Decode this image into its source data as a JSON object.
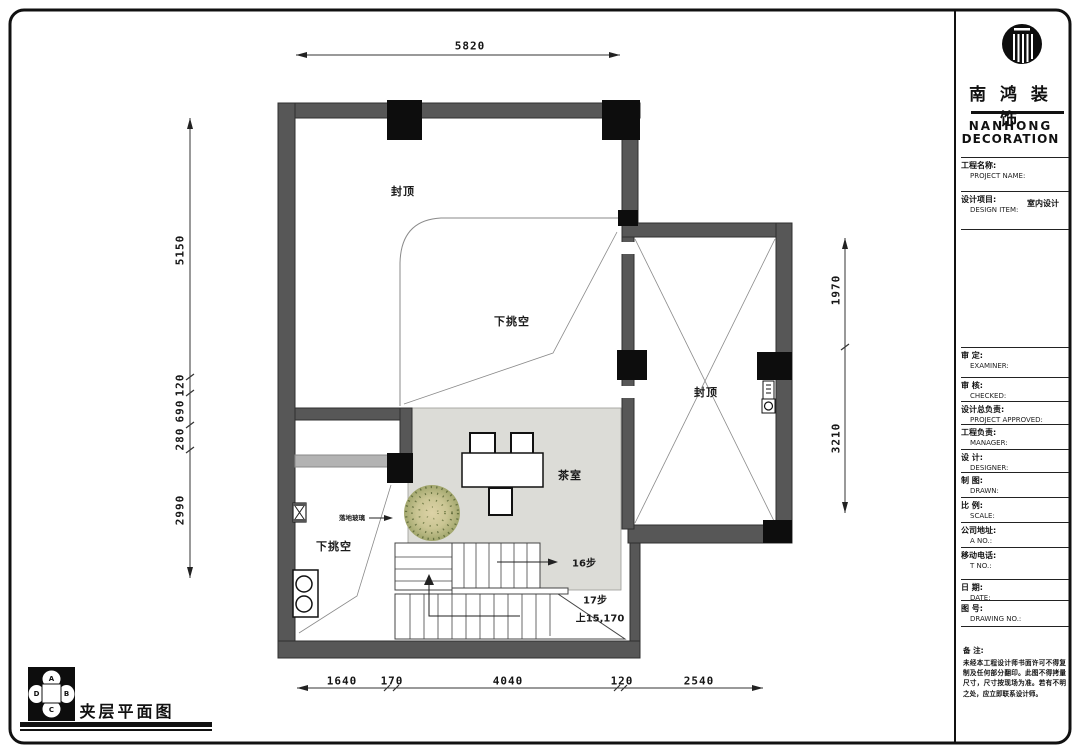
{
  "plan": {
    "rooms": {
      "capped_top": "封顶",
      "void_main": "下挑空",
      "tea_room": "茶室",
      "capped_right": "封顶",
      "void_lower": "下挑空"
    },
    "annotations": {
      "floor_glass": "落地玻璃",
      "steps_upper": "16步",
      "steps_lower": "17步",
      "up_elevation": "上15,170"
    },
    "dimensions": {
      "top": "5820",
      "left_1": "5150",
      "left_2": "120",
      "left_3": "690",
      "left_4": "280",
      "left_5": "2990",
      "right_1": "1970",
      "right_2": "3210",
      "bottom_1": "1640",
      "bottom_2": "170",
      "bottom_3": "4040",
      "bottom_4": "120",
      "bottom_5": "2540"
    }
  },
  "footer": {
    "drawing_title": "夹层平面图",
    "compass": {
      "top": "A",
      "right": "B",
      "bottom": "C",
      "left": "D"
    }
  },
  "titleblock": {
    "brand_cn": "南 鸿 装 饰",
    "brand_en_line1": "NANHONG",
    "brand_en_line2": "DECORATION",
    "fields": [
      {
        "cn": "工程名称:",
        "en": "PROJECT NAME:",
        "value": ""
      },
      {
        "cn": "设计项目:",
        "en": "DESIGN ITEM:",
        "value": "室内设计"
      },
      {
        "cn": "审  定:",
        "en": "EXAMINER:",
        "value": ""
      },
      {
        "cn": "审  核:",
        "en": "CHECKED:",
        "value": ""
      },
      {
        "cn": "设计总负责:",
        "en": "PROJECT APPROVED:",
        "value": ""
      },
      {
        "cn": "工程负责:",
        "en": "MANAGER:",
        "value": ""
      },
      {
        "cn": "设  计:",
        "en": "DESIGNER:",
        "value": ""
      },
      {
        "cn": "制  图:",
        "en": "DRAWN:",
        "value": ""
      },
      {
        "cn": "比  例:",
        "en": "SCALE:",
        "value": ""
      },
      {
        "cn": "公司地址:",
        "en": "A  NO.:",
        "value": ""
      },
      {
        "cn": "移动电话:",
        "en": "T  NO.:",
        "value": ""
      },
      {
        "cn": "日  期:",
        "en": "DATE:",
        "value": ""
      },
      {
        "cn": "图  号:",
        "en": "DRAWING NO.:",
        "value": ""
      }
    ],
    "notes_label": "备 注:",
    "notes": "未经本工程设计师书面许可不得复制及任何部分翻印。此图不得拷量尺寸，尺寸按现场为准。若有不明之处，应立即联系设计师。"
  }
}
